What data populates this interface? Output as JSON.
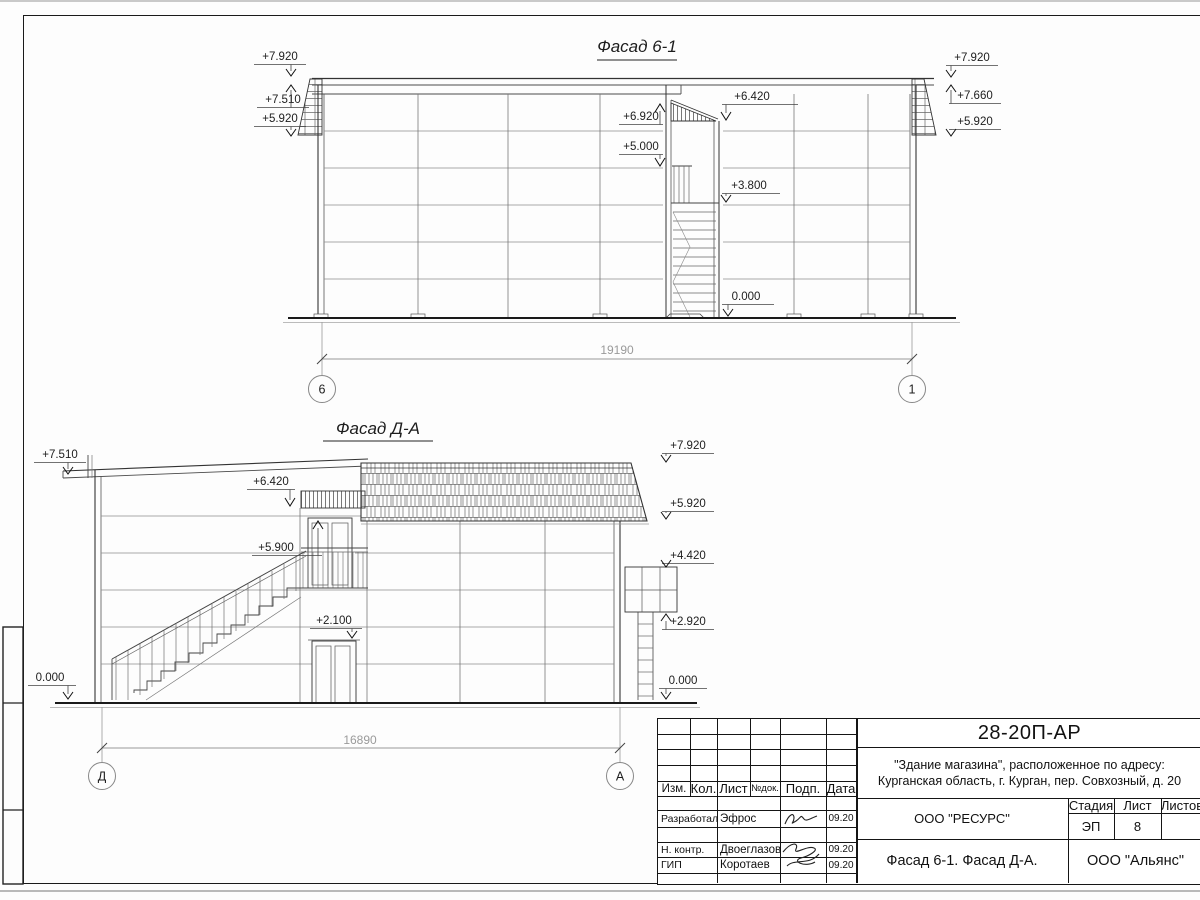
{
  "facade_top": {
    "title": "Фасад 6-1",
    "dim": "19190",
    "axes": [
      "6",
      "1"
    ],
    "marks": {
      "left": [
        "+7.920",
        "+7.510",
        "+5.920"
      ],
      "mid": [
        "+6.920",
        "+5.000",
        "+6.420",
        "+3.800",
        "0.000"
      ],
      "right": [
        "+7.920",
        "+7.660",
        "+5.920"
      ]
    }
  },
  "facade_bottom": {
    "title": "Фасад Д-А",
    "dim": "16890",
    "axes": [
      "Д",
      "А"
    ],
    "marks": {
      "left": [
        "+7.510",
        "0.000"
      ],
      "mid": [
        "+6.420",
        "+5.900",
        "+2.100"
      ],
      "right": [
        "+7.920",
        "+5.920",
        "+4.420",
        "+2.920",
        "0.000"
      ]
    }
  },
  "title_block": {
    "code": "28-20П-АР",
    "object_line1": "\"Здание магазина\", расположенное по адресу:",
    "object_line2": "Курганская область, г. Курган, пер. Совхозный, д. 20",
    "rev_columns": [
      "Изм.",
      "Кол.",
      "Лист",
      "№док.",
      "Подп.",
      "Дата"
    ],
    "signature_rows": [
      {
        "role": "Разработал",
        "name": "Эфрос",
        "date": "09.20"
      },
      {
        "role": "Н. контр.",
        "name": "Двоеглазов",
        "date": "09.20"
      },
      {
        "role": "ГИП",
        "name": "Коротаев",
        "date": "09.20"
      }
    ],
    "org_top": "ООО \"РЕСУРС\"",
    "drawing_title": "Фасад 6-1. Фасад Д-А.",
    "org_bottom": "ООО \"Альянс\"",
    "stage": {
      "label": "Стадия",
      "value": "ЭП"
    },
    "sheet": {
      "label": "Лист",
      "value": "8"
    },
    "sheets": {
      "label": "Листов",
      "value": ""
    }
  }
}
